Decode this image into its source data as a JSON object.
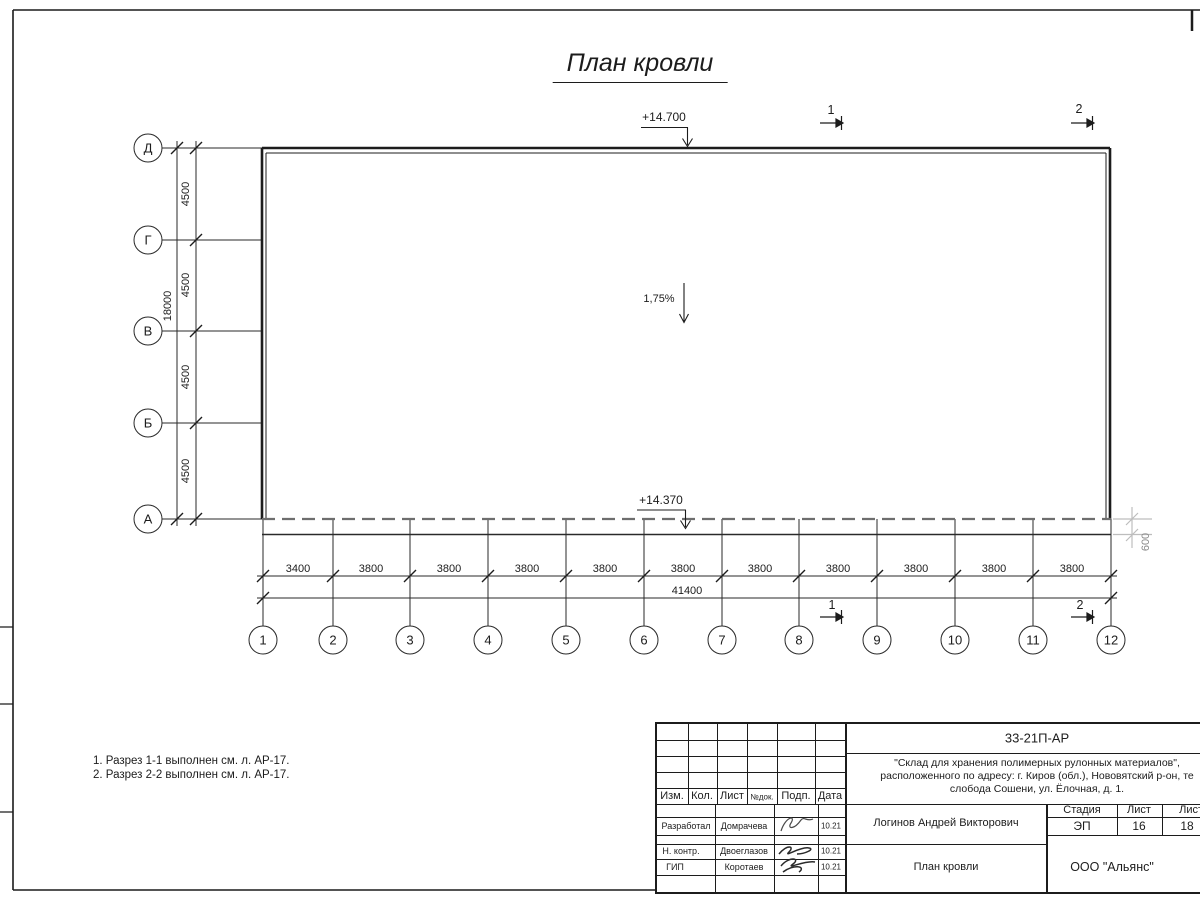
{
  "sheet": {
    "title": "План кровли",
    "notes": [
      "1. Разрез 1-1 выполнен см. л. АР-17.",
      "2. Разрез 2-2 выполнен см. л. АР-17."
    ]
  },
  "plan": {
    "elevation_top": "+14.700",
    "elevation_bottom": "+14.370",
    "slope": "1,75%",
    "overhang_dim": "600",
    "section_1": "1",
    "section_2": "2"
  },
  "grid": {
    "letter_axes": [
      "Д",
      "Г",
      "В",
      "Б",
      "А"
    ],
    "number_axes": [
      "1",
      "2",
      "3",
      "4",
      "5",
      "6",
      "7",
      "8",
      "9",
      "10",
      "11",
      "12"
    ],
    "left_dims": [
      "4500",
      "4500",
      "4500",
      "4500"
    ],
    "left_total": "18000",
    "bottom_dims": [
      "3400",
      "3800",
      "3800",
      "3800",
      "3800",
      "3800",
      "3800",
      "3800",
      "3800",
      "3800",
      "3800"
    ],
    "bottom_total": "41400"
  },
  "title_block": {
    "code": "33-21П-АР",
    "project_line1": "\"Склад для хранения полимерных рулонных материалов\",",
    "project_line2": "расположенного по адресу: г. Киров (обл.), Нововятский р-он, те",
    "project_line3": "слобода Сошени, ул. Ёлочная, д. 1.",
    "header": {
      "izm": "Изм.",
      "kol": "Кол.",
      "list": "Лист",
      "ndok": "№док.",
      "podp": "Подп.",
      "data": "Дата"
    },
    "rows": [
      {
        "role": "Разработал",
        "name": "Домрачева",
        "date": "10.21"
      },
      {
        "role": "Н. контр.",
        "name": "Двоеглазов",
        "date": "10.21"
      },
      {
        "role": "ГИП",
        "name": "Коротаев",
        "date": "10.21"
      }
    ],
    "approver": "Логинов Андрей Викторович",
    "stage_header": {
      "stage": "Стадия",
      "sheet": "Лист",
      "sheets": "Листов"
    },
    "stage_values": {
      "stage": "ЭП",
      "sheet": "16",
      "sheets": "18"
    },
    "doc_title": "План кровли",
    "company": "ООО \"Альянс\""
  }
}
